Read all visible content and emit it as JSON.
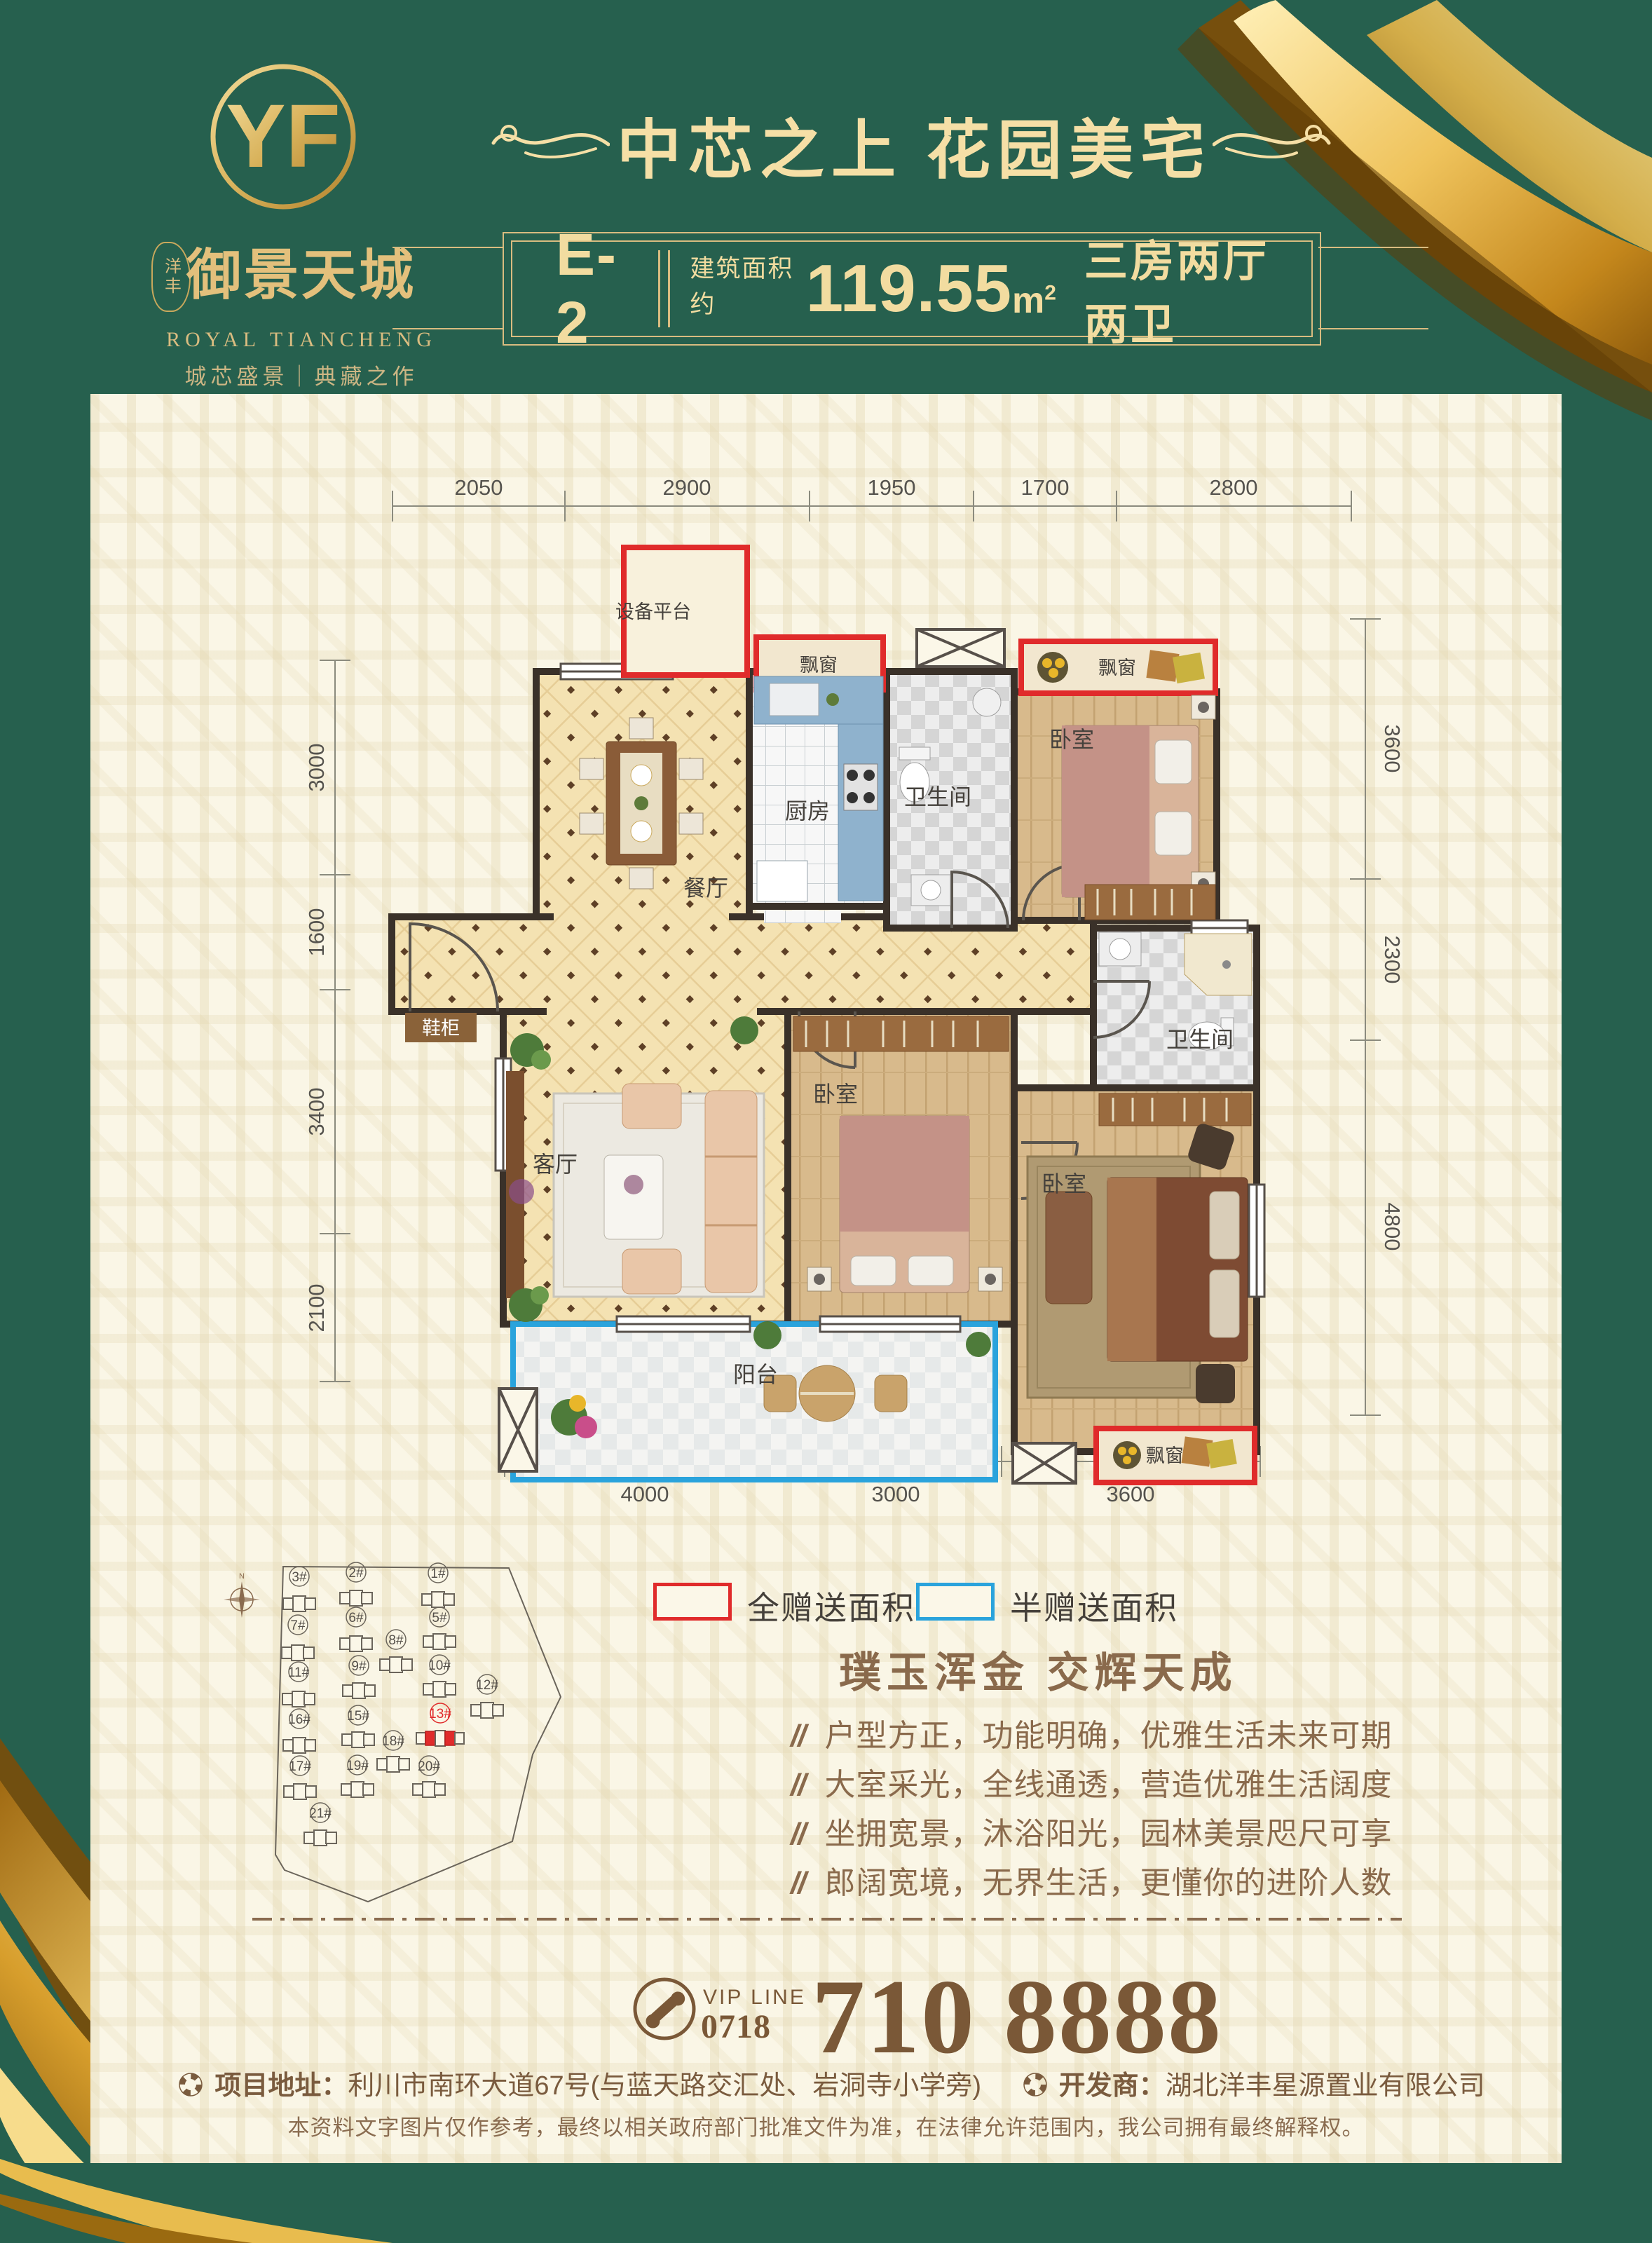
{
  "brand": {
    "logo_monogram": "YF",
    "seal_text": "洋丰",
    "name_cn": "御景天城",
    "name_en": "ROYAL TIANCHENG",
    "tagline": "城芯盛景｜典藏之作"
  },
  "header": {
    "title": "中芯之上  花园美宅",
    "unit_label": "E-2",
    "area_prefix": "建筑面积约",
    "area_value": "119.55",
    "area_unit": "m",
    "area_sup": "2",
    "layout_desc": "三房两厅两卫"
  },
  "floorplan": {
    "dims_top": [
      "2050",
      "2900",
      "1950",
      "1700",
      "2800"
    ],
    "dims_left": [
      "3000",
      "1600",
      "3400",
      "2100"
    ],
    "dims_right": [
      "3600",
      "2300",
      "4800"
    ],
    "dims_bottom": [
      "4000",
      "3000",
      "3600"
    ],
    "rooms": {
      "equipment": "设备平台",
      "bay_window": "飘窗",
      "kitchen": "厨房",
      "bath": "卫生间",
      "bedroom": "卧室",
      "dining": "餐厅",
      "shoe_cabinet": "鞋柜",
      "living": "客厅",
      "balcony": "阳台"
    }
  },
  "legend": {
    "full_gift": "全赠送面积",
    "half_gift": "半赠送面积"
  },
  "siteplan": {
    "buildings": [
      "3#",
      "2#",
      "1#",
      "7#",
      "6#",
      "5#",
      "8#",
      "11#",
      "9#",
      "10#",
      "12#",
      "16#",
      "15#",
      "13#",
      "18#",
      "17#",
      "19#",
      "20#",
      "21#"
    ],
    "highlighted": "13#"
  },
  "selling": {
    "title": "璞玉浑金  交辉天成",
    "bullet_mark": "//",
    "bullets": [
      "户型方正，功能明确，优雅生活未来可期",
      "大室采光，全线通透，营造优雅生活阔度",
      "坐拥宽景，沐浴阳光，园林美景咫尺可享",
      "郎阔宽境，无界生活，更懂你的进阶人数"
    ]
  },
  "contact": {
    "vip_line_label": "VIP LINE",
    "area_code": "0718",
    "phone": "710 8888"
  },
  "footer": {
    "address_label": "项目地址：",
    "address": "利川市南环大道67号(与蓝天路交汇处、岩洞寺小学旁)",
    "developer_label": "开发商：",
    "developer": "湖北洋丰星源置业有限公司",
    "disclaimer": "本资料文字图片仅作参考，最终以相关政府部门批准文件为准，在法律允许范围内，我公司拥有最终解释权。"
  },
  "colors": {
    "primary_green": "#26604E",
    "panel_cream": "#FAF6E6",
    "accent_red": "#E02B2B",
    "accent_blue": "#2AA3DC",
    "gold": "#E3C07C",
    "text_brown": "#7A5B3E"
  }
}
